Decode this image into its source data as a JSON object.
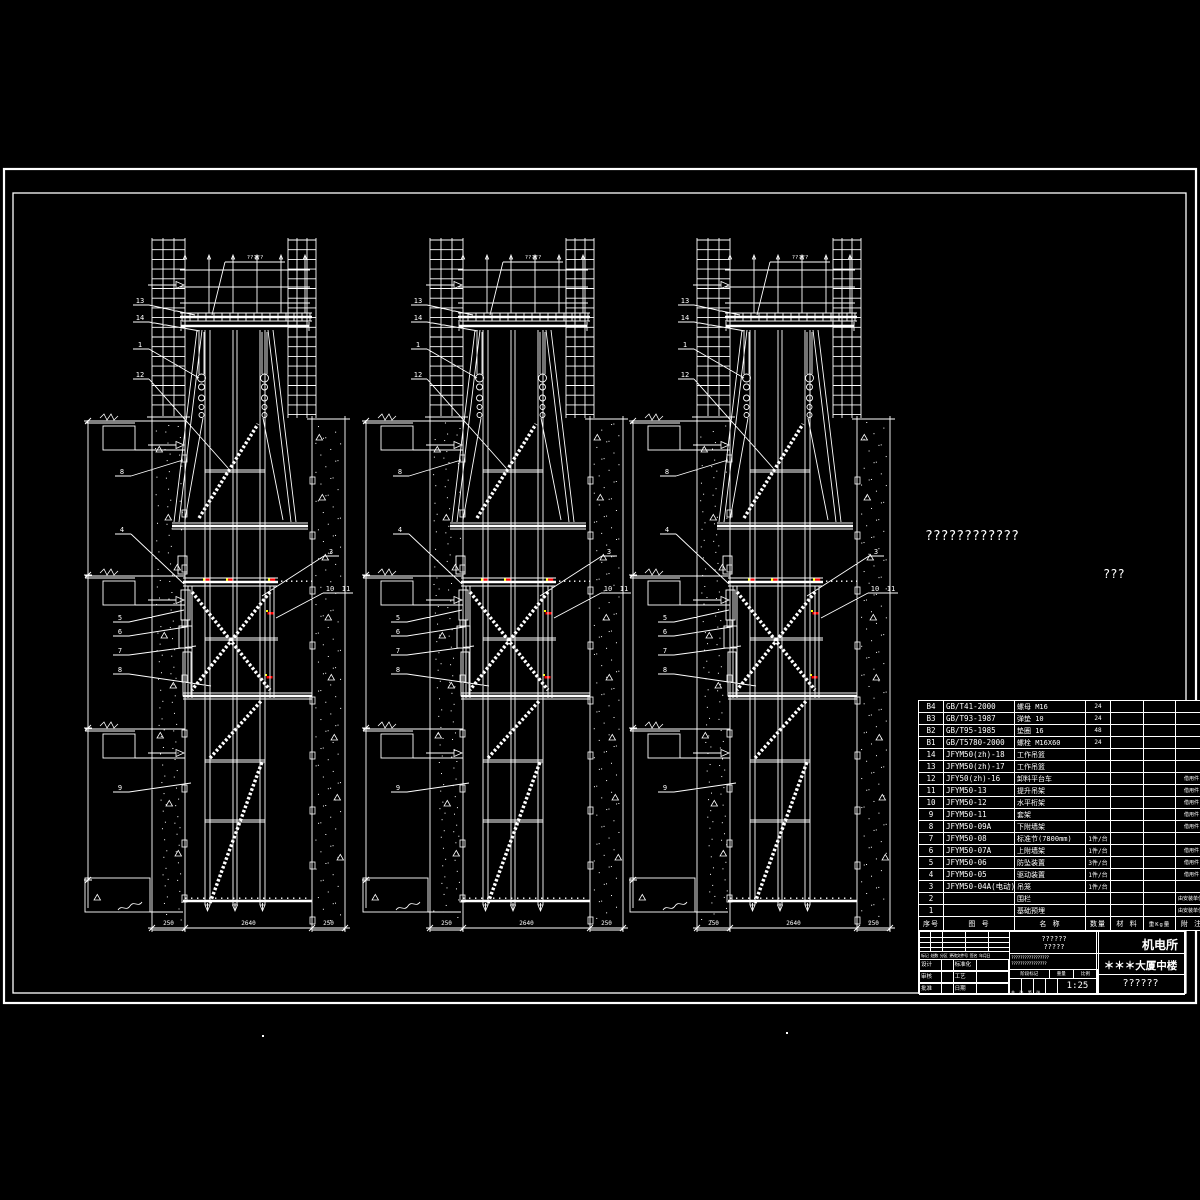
{
  "drawing": {
    "background": "#000000",
    "line_color": "#ffffff",
    "marker_red": "#ff0000",
    "marker_yellow": "#ffff00",
    "view_count": 3,
    "top_annotation": "?????",
    "bottom_dims": [
      "250",
      "2640",
      "250"
    ],
    "leader_labels_left": [
      "13",
      "14",
      "1",
      "12",
      "8",
      "4",
      "5",
      "6",
      "7",
      "8",
      "9"
    ],
    "leader_labels_right": [
      "3",
      "10",
      "11"
    ],
    "floating_text_1": "????????????",
    "floating_text_2": "???"
  },
  "parts_table": {
    "headers": [
      "序号",
      "图    号",
      "名   称",
      "数量",
      "材 料",
      "重Kg量",
      "附 注"
    ],
    "rows": [
      [
        "B4",
        "GB/T41-2000",
        "螺母 M16",
        "24",
        "",
        "",
        ""
      ],
      [
        "B3",
        "GB/T93-1987",
        "弹垫 10",
        "24",
        "",
        "",
        ""
      ],
      [
        "B2",
        "GB/T95-1985",
        "垫圈 16",
        "48",
        "",
        "",
        ""
      ],
      [
        "B1",
        "GB/T5780-2000",
        "螺栓 M16X60",
        "24",
        "",
        "",
        ""
      ],
      [
        "14",
        "JFYM50(zh)-18",
        "工作吊篮",
        "",
        "",
        "",
        ""
      ],
      [
        "13",
        "JFYM50(zh)-17",
        "工作吊篮",
        "",
        "",
        "",
        ""
      ],
      [
        "12",
        "JFY50(zh)-16",
        "卸料平台车",
        "",
        "",
        "",
        "借用件"
      ],
      [
        "11",
        "JFYM50-13",
        "提升吊架",
        "",
        "",
        "",
        "借用件"
      ],
      [
        "10",
        "JFYM50-12",
        "水平桁架",
        "",
        "",
        "",
        "借用件"
      ],
      [
        "9",
        "JFYM50-11",
        "套架",
        "",
        "",
        "",
        "借用件"
      ],
      [
        "8",
        "JFYM50-09A",
        "下附墙架",
        "",
        "",
        "",
        "借用件"
      ],
      [
        "7",
        "JFYM50-08",
        "标准节(7800mm)",
        "1件/台",
        "",
        "",
        ""
      ],
      [
        "6",
        "JFYM50-07A",
        "上附墙架",
        "1件/台",
        "",
        "",
        "借用件"
      ],
      [
        "5",
        "JFYM50-06",
        "防坠装置",
        "3件/台",
        "",
        "",
        "借用件"
      ],
      [
        "4",
        "JFYM50-05",
        "驱动装置",
        "1件/台",
        "",
        "",
        "借用件"
      ],
      [
        "3",
        "JFYM50-04A(电动)",
        "吊笼",
        "1件/台",
        "",
        "",
        ""
      ],
      [
        "2",
        "",
        "围栏",
        "",
        "",
        "",
        "由安装单位定"
      ],
      [
        "1",
        "",
        "基础预埋",
        "",
        "",
        "",
        "由安装单位定"
      ]
    ]
  },
  "title_block": {
    "org": "机电所",
    "project": "＊＊＊大厦中楼",
    "drawing_no": "??????",
    "scale": "1:25",
    "code_line1": "??????",
    "code_line2": "?????",
    "note_line1": "?????????????????",
    "note_line2": "????????????????",
    "rev_header": "标记 处数 分区 更改文件号 签名 年月日",
    "stage_labels": [
      "阶段标记",
      "重量",
      "比例"
    ],
    "sign_rows": [
      [
        "设计",
        "",
        "标准化",
        ""
      ],
      [
        "审核",
        "",
        "工艺",
        ""
      ],
      [
        "批准",
        "",
        "日期",
        ""
      ]
    ],
    "sheet_note": "共 张 第 张"
  }
}
